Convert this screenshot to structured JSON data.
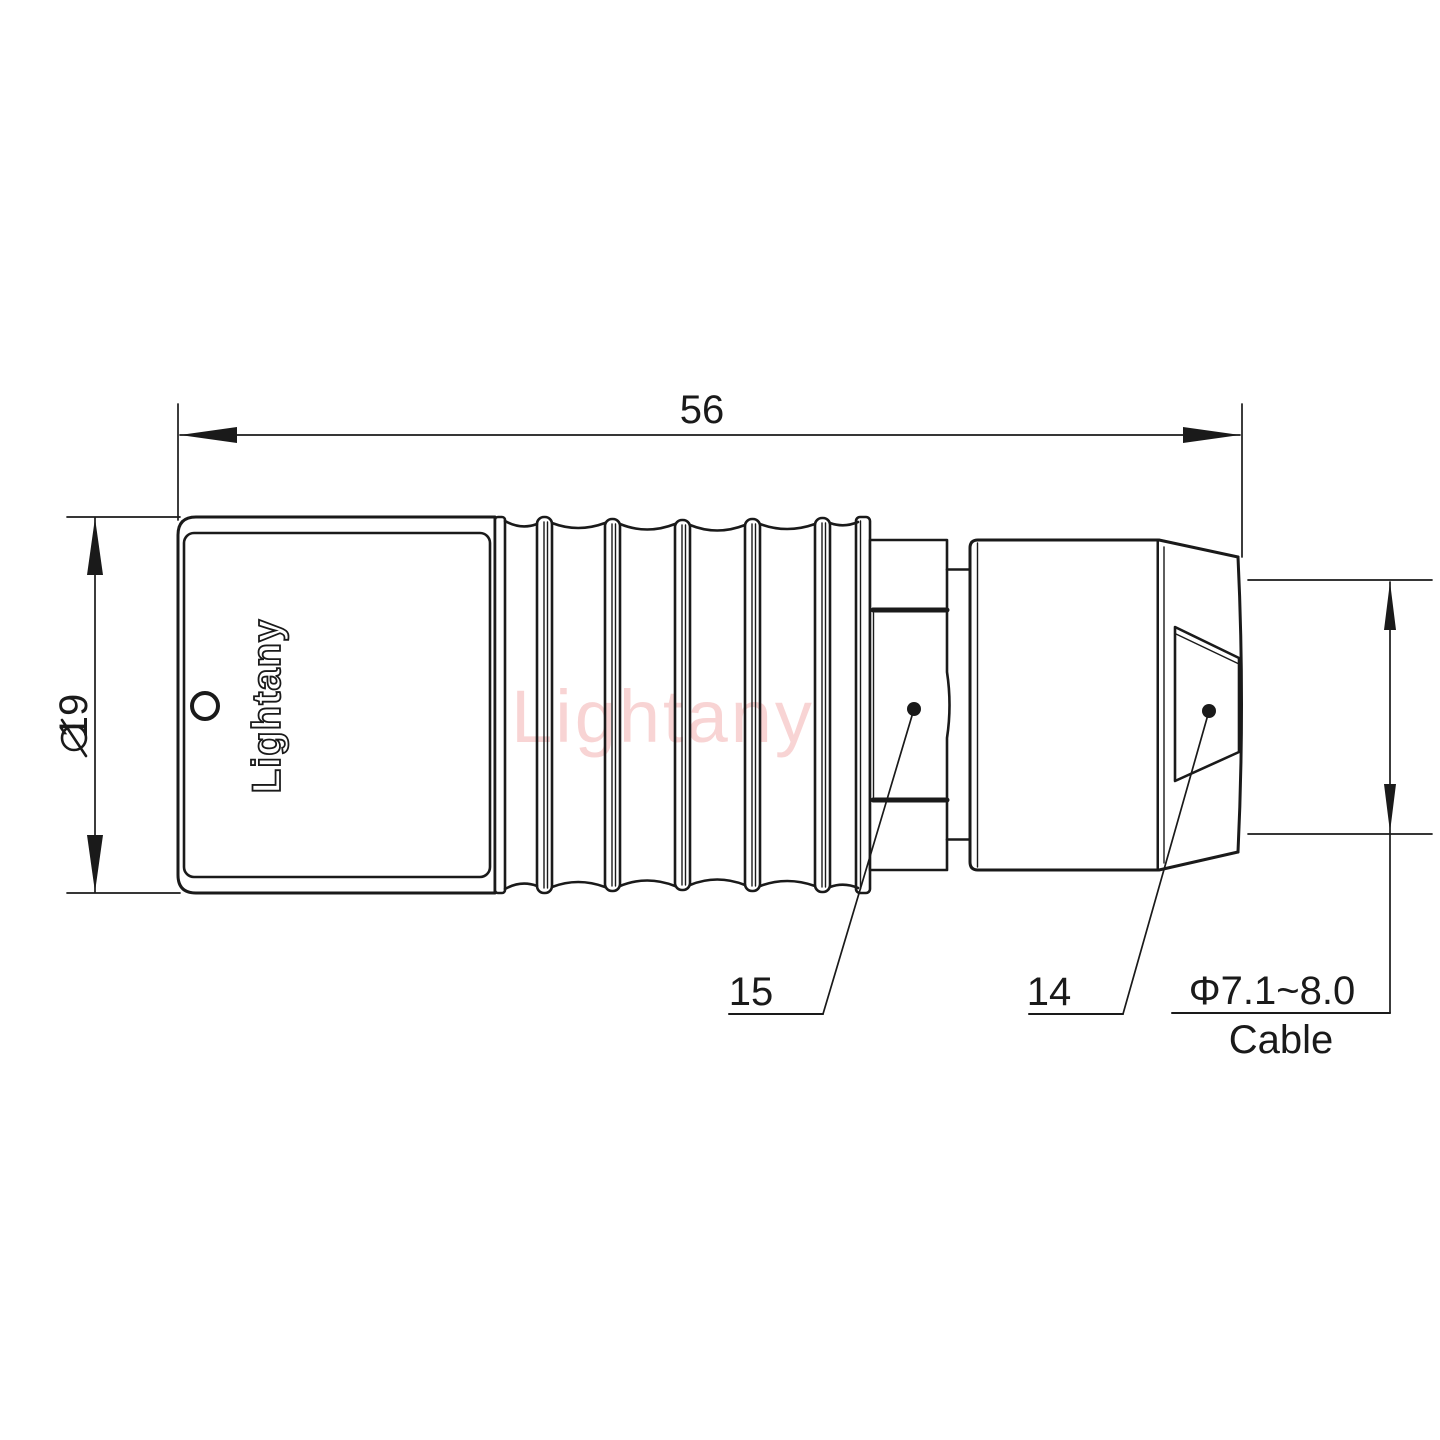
{
  "watermark": "Lightany",
  "shell": {
    "engraving": "Lightany"
  },
  "dimensions": {
    "length": {
      "value": "56"
    },
    "diameter": {
      "symbol": "⌀",
      "value": "19"
    },
    "cable_range": {
      "value": "Φ7.1~8.0"
    },
    "cable_label": {
      "value": "Cable"
    }
  },
  "part_labels": {
    "coupling_nut": "15",
    "rear_cone": "14"
  },
  "colors": {
    "line": "#1a1a1a",
    "watermark": "#f2abab",
    "background": "#ffffff"
  }
}
